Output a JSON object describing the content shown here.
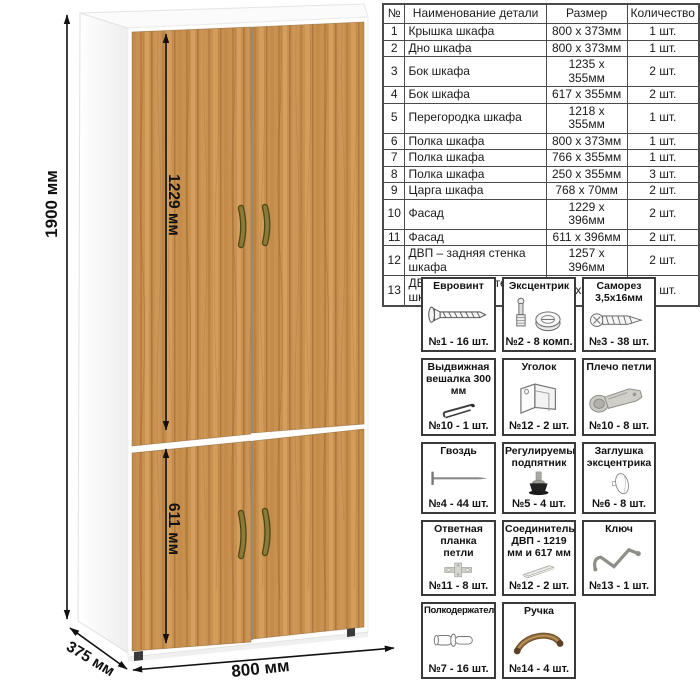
{
  "wardrobe": {
    "dim_height": "1900 мм",
    "dim_upper_door": "1229 мм",
    "dim_lower_door": "611 мм",
    "dim_width": "800 мм",
    "dim_depth": "375 мм",
    "colors": {
      "wood": "#c9914f",
      "wood_dark": "#9a6530",
      "carcass": "#ffffff",
      "handle": "#8a7b38",
      "dimension": "#111111"
    }
  },
  "parts_table": {
    "headers": [
      "№",
      "Наименование детали",
      "Размер",
      "Количество"
    ],
    "rows": [
      {
        "num": "1",
        "name": "Крышка шкафа",
        "size": "800 х 373мм",
        "qty": "1 шт."
      },
      {
        "num": "2",
        "name": "Дно шкафа",
        "size": "800 х 373мм",
        "qty": "1 шт."
      },
      {
        "num": "3",
        "name": "Бок шкафа",
        "size": "1235 х 355мм",
        "qty": "2 шт."
      },
      {
        "num": "4",
        "name": "Бок шкафа",
        "size": "617 х 355мм",
        "qty": "2 шт."
      },
      {
        "num": "5",
        "name": "Перегородка шкафа",
        "size": "1218 х 355мм",
        "qty": "1 шт."
      },
      {
        "num": "6",
        "name": "Полка шкафа",
        "size": "800 х 373мм",
        "qty": "1 шт."
      },
      {
        "num": "7",
        "name": "Полка шкафа",
        "size": "766 х 355мм",
        "qty": "1 шт."
      },
      {
        "num": "8",
        "name": "Полка шкафа",
        "size": "250 х 355мм",
        "qty": "3 шт."
      },
      {
        "num": "9",
        "name": "Царга шкафа",
        "size": "768 х 70мм",
        "qty": "2 шт."
      },
      {
        "num": "10",
        "name": "Фасад",
        "size": "1229 х 396мм",
        "qty": "2 шт."
      },
      {
        "num": "11",
        "name": "Фасад",
        "size": "611 х 396мм",
        "qty": "2 шт."
      },
      {
        "num": "12",
        "name": "ДВП – задняя стенка шкафа",
        "size": "1257 х 396мм",
        "qty": "2 шт."
      },
      {
        "num": "13",
        "name": "ДВП – задняя стенка шкафа",
        "size": "639 х 396мм",
        "qty": "2 шт."
      }
    ]
  },
  "hardware": {
    "items": [
      {
        "title": "Евровинт",
        "label": "№1 - 16 шт.",
        "icon": "euro-screw-icon"
      },
      {
        "title": "Эксцентрик",
        "label": "№2 - 8 комп.",
        "icon": "cam-lock-icon"
      },
      {
        "title": "Саморез 3,5х16мм",
        "label": "№3 - 38 шт.",
        "icon": "screw-icon"
      },
      {
        "title": "Выдвижная вешалка 300 мм",
        "label": "№10 - 1 шт.",
        "icon": "pullout-hanger-icon"
      },
      {
        "title": "Уголок",
        "label": "№12 - 2 шт.",
        "icon": "corner-bracket-icon"
      },
      {
        "title": "Плечо петли",
        "label": "№10 - 8 шт.",
        "icon": "hinge-arm-icon"
      },
      {
        "title": "Гвоздь",
        "label": "№4 - 44 шт.",
        "icon": "nail-icon"
      },
      {
        "title": "Регулируемый подпятник",
        "label": "№5 - 4 шт.",
        "icon": "adjustable-foot-icon"
      },
      {
        "title": "Заглушка эксцентрика",
        "label": "№6 - 8 шт.",
        "icon": "cam-cover-icon"
      },
      {
        "title": "Ответная планка петли",
        "label": "№11 - 8 шт.",
        "icon": "hinge-plate-icon"
      },
      {
        "title": "Соединитель ДВП - 1219 мм и 617 мм",
        "label": "№12 - 2 шт.",
        "icon": "hdf-connector-icon"
      },
      {
        "title": "Ключ",
        "label": "№13 - 1 шт.",
        "icon": "hex-key-icon"
      },
      {
        "title": "Полкодержатель",
        "label": "№7 - 16 шт.",
        "icon": "shelf-pin-icon"
      },
      {
        "title": "Ручка",
        "label": "№14 - 4 шт.",
        "icon": "handle-icon"
      }
    ]
  }
}
